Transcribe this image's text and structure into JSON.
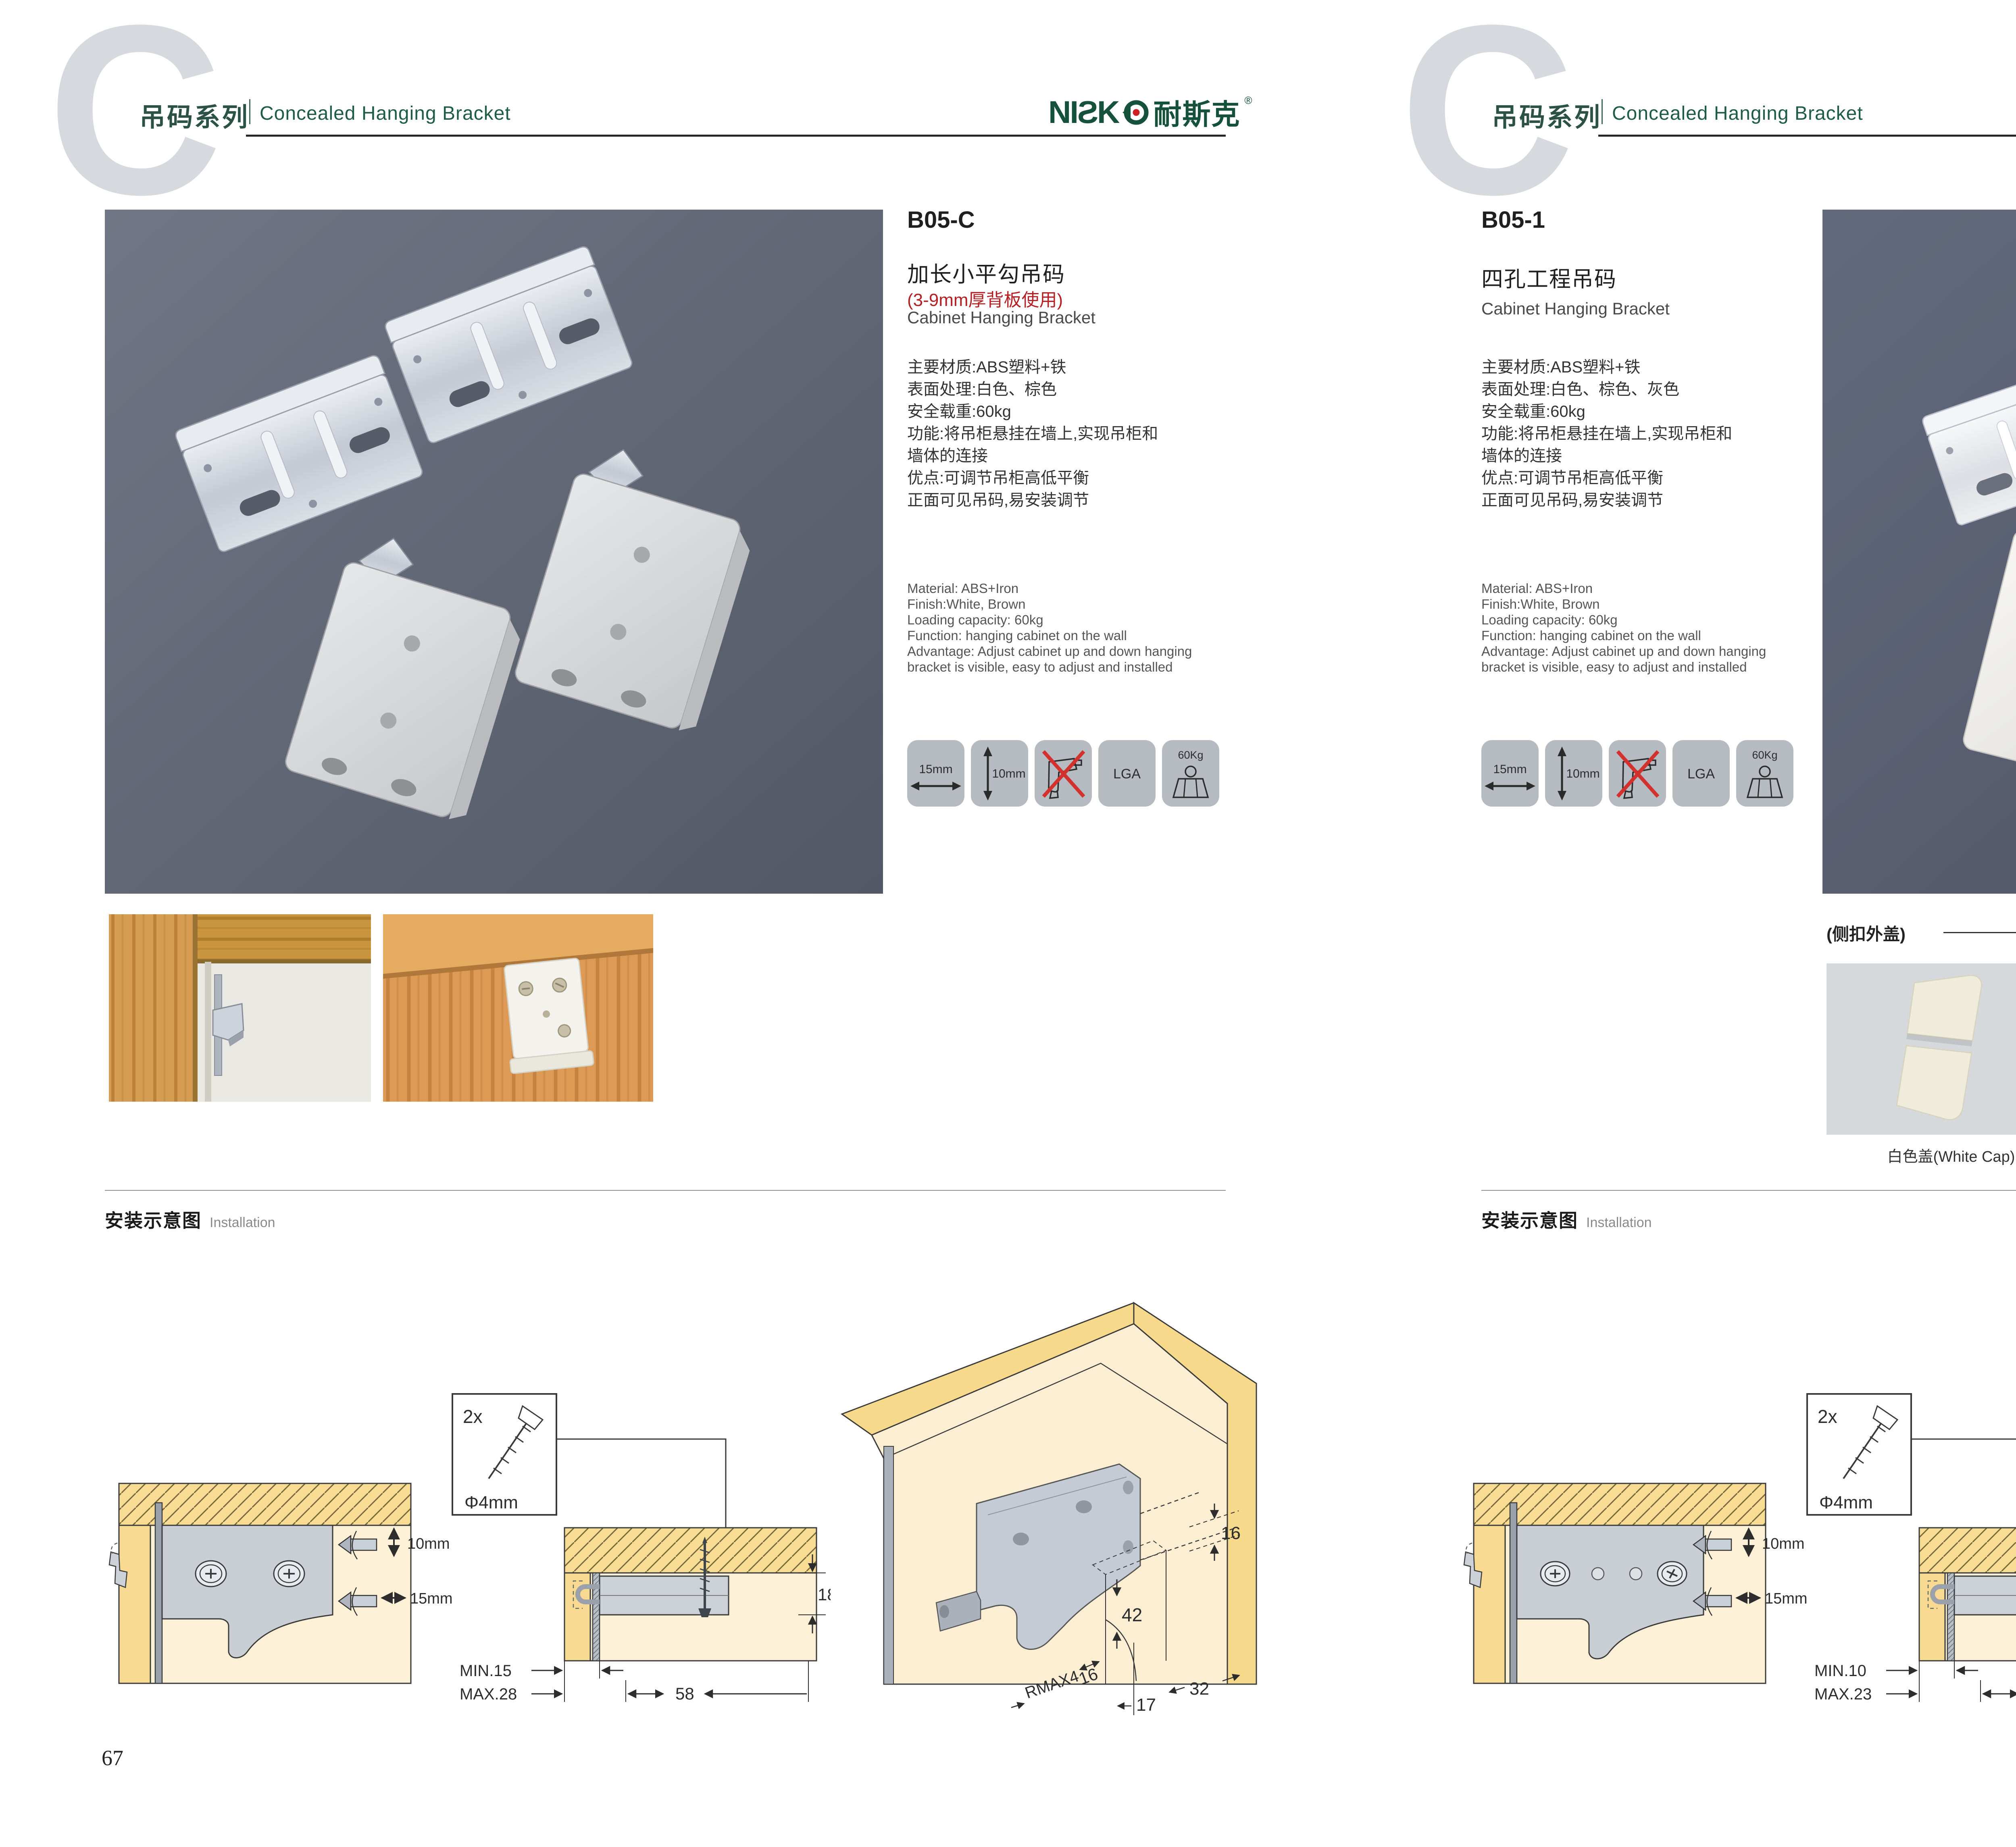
{
  "header": {
    "watermark_letter": "C",
    "series_zh": "吊码系列",
    "series_en": "Concealed Hanging Bracket",
    "logo_latin": "NIƧK",
    "logo_zh": "耐斯克",
    "logo_reg": "®"
  },
  "icons": {
    "width_label": "15mm",
    "height_label": "10mm",
    "cert_label": "LGA",
    "load_label": "60Kg"
  },
  "left_page": {
    "model": "B05-C",
    "title_zh": "加长小平勾吊码",
    "subtitle_red": "(3-9mm厚背板使用)",
    "title_en": "Cabinet Hanging Bracket",
    "specs_zh": [
      "主要材质:ABS塑料+铁",
      "表面处理:白色、棕色",
      "安全载重:60kg",
      "功能:将吊柜悬挂在墙上,实现吊柜和",
      "墙体的连接",
      "优点:可调节吊柜高低平衡",
      "正面可见吊码,易安装调节"
    ],
    "specs_en": [
      "Material: ABS+Iron",
      "Finish:White, Brown",
      "Loading capacity: 60kg",
      "Function: hanging cabinet on the wall",
      "Advantage: Adjust cabinet up and down hanging",
      "bracket is visible, easy to adjust and installed"
    ],
    "install_zh": "安装示意图",
    "install_en": "Installation",
    "page_number": "67",
    "d1": {
      "v": "10mm",
      "h": "15mm"
    },
    "d2": {
      "qty": "2x",
      "dia": "Φ4mm",
      "t": "18",
      "min": "MIN.15",
      "max": "MAX.28",
      "w": "58"
    },
    "d3": {
      "top": "16",
      "h": "42",
      "r": "RMAX4",
      "side": "16",
      "front": "17",
      "pitch": "32"
    }
  },
  "right_page": {
    "model": "B05-1",
    "title_zh": "四孔工程吊码",
    "title_en": "Cabinet Hanging Bracket",
    "specs_zh": [
      "主要材质:ABS塑料+铁",
      "表面处理:白色、棕色、灰色",
      "安全载重:60kg",
      "功能:将吊柜悬挂在墙上,实现吊柜和",
      "墙体的连接",
      "优点:可调节吊柜高低平衡",
      "正面可见吊码,易安装调节"
    ],
    "specs_en": [
      "Material: ABS+Iron",
      "Finish:White, Brown",
      "Loading capacity: 60kg",
      "Function: hanging cabinet on the wall",
      "Advantage: Adjust cabinet up and down hanging",
      "bracket is visible, easy to adjust and installed"
    ],
    "caps": {
      "heading": "(侧扣外盖)",
      "items": [
        {
          "label": "白色盖(White Cap)",
          "color": "#f0ecdb"
        },
        {
          "label": "灰色盖(Gray Cap)",
          "color": "#b5b2a6"
        },
        {
          "label": "棕色盖(Silver Cap)",
          "color": "#c8693c"
        }
      ]
    },
    "install_zh": "安装示意图",
    "install_en": "Installation",
    "page_number": "68",
    "d1": {
      "v": "10mm",
      "h": "15mm"
    },
    "d2": {
      "qty": "2x",
      "dia": "Φ4mm",
      "t": "18",
      "min": "MIN.10",
      "max": "MAX.23",
      "w": "58"
    },
    "d3": {
      "top": "16",
      "h": "42",
      "r": "RMAX4",
      "side": "16",
      "front": "17",
      "pitch": "32"
    }
  }
}
